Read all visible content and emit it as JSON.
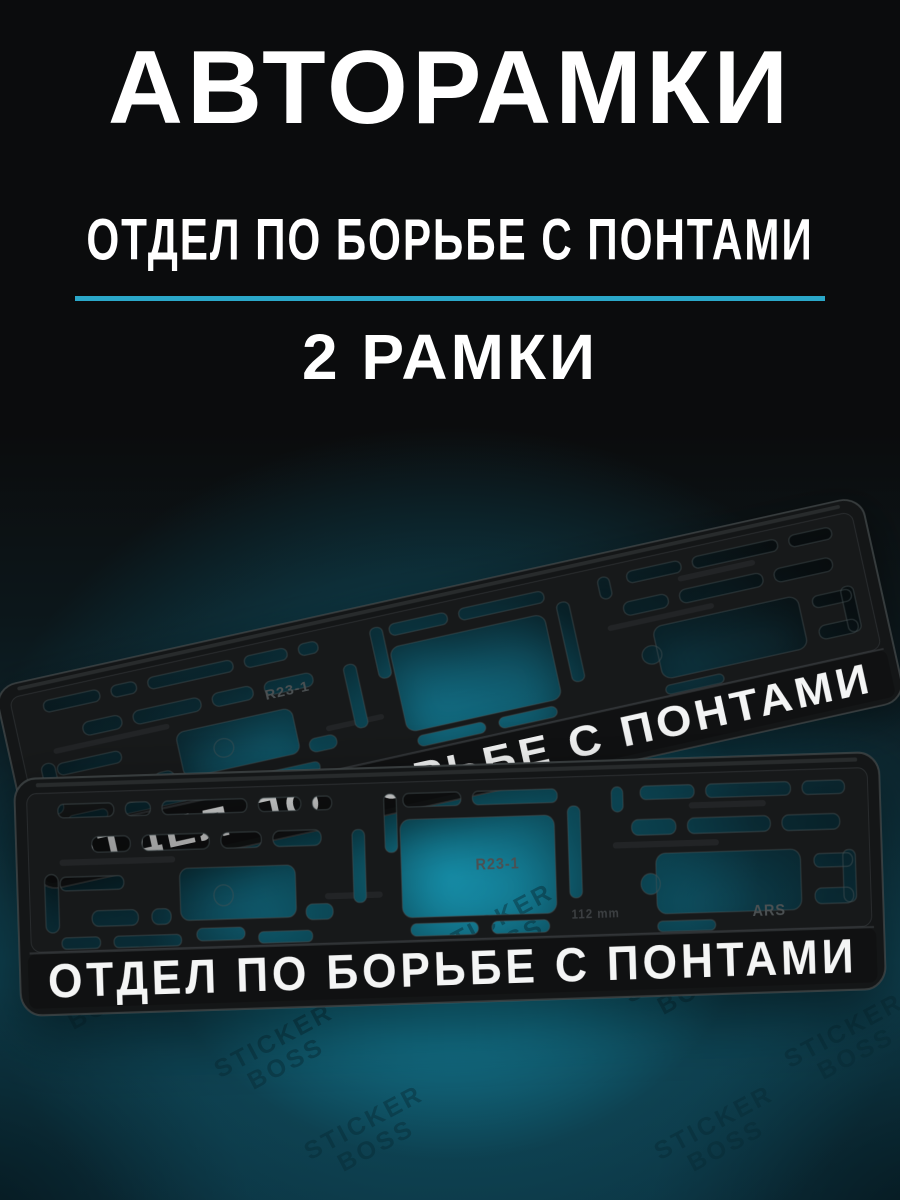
{
  "header": {
    "title": "АВТОРАМКИ",
    "subtitle": "ОТДЕЛ ПО БОРЬБЕ С ПОНТАМИ",
    "count_label": "2 РАМКИ",
    "divider_color": "#2ba8c9",
    "text_color": "#ffffff"
  },
  "scene": {
    "watermark": "STICKER\nBOSS",
    "background_black": "#0b0c0d",
    "background_teal_glow": "#1796b2",
    "frame_plastic_color": "#141617"
  },
  "frames": {
    "front": {
      "plate_text": "ОТДЕЛ ПО БОРЬБЕ С ПОНТАМИ",
      "marking_model": "R23-1",
      "marking_brand": "ARS",
      "marking_size": "112 mm"
    },
    "back": {
      "plate_text": "ОТДЕЛ ПО БОРЬБЕ С ПОНТАМИ",
      "marking_model": "R23-1"
    }
  }
}
